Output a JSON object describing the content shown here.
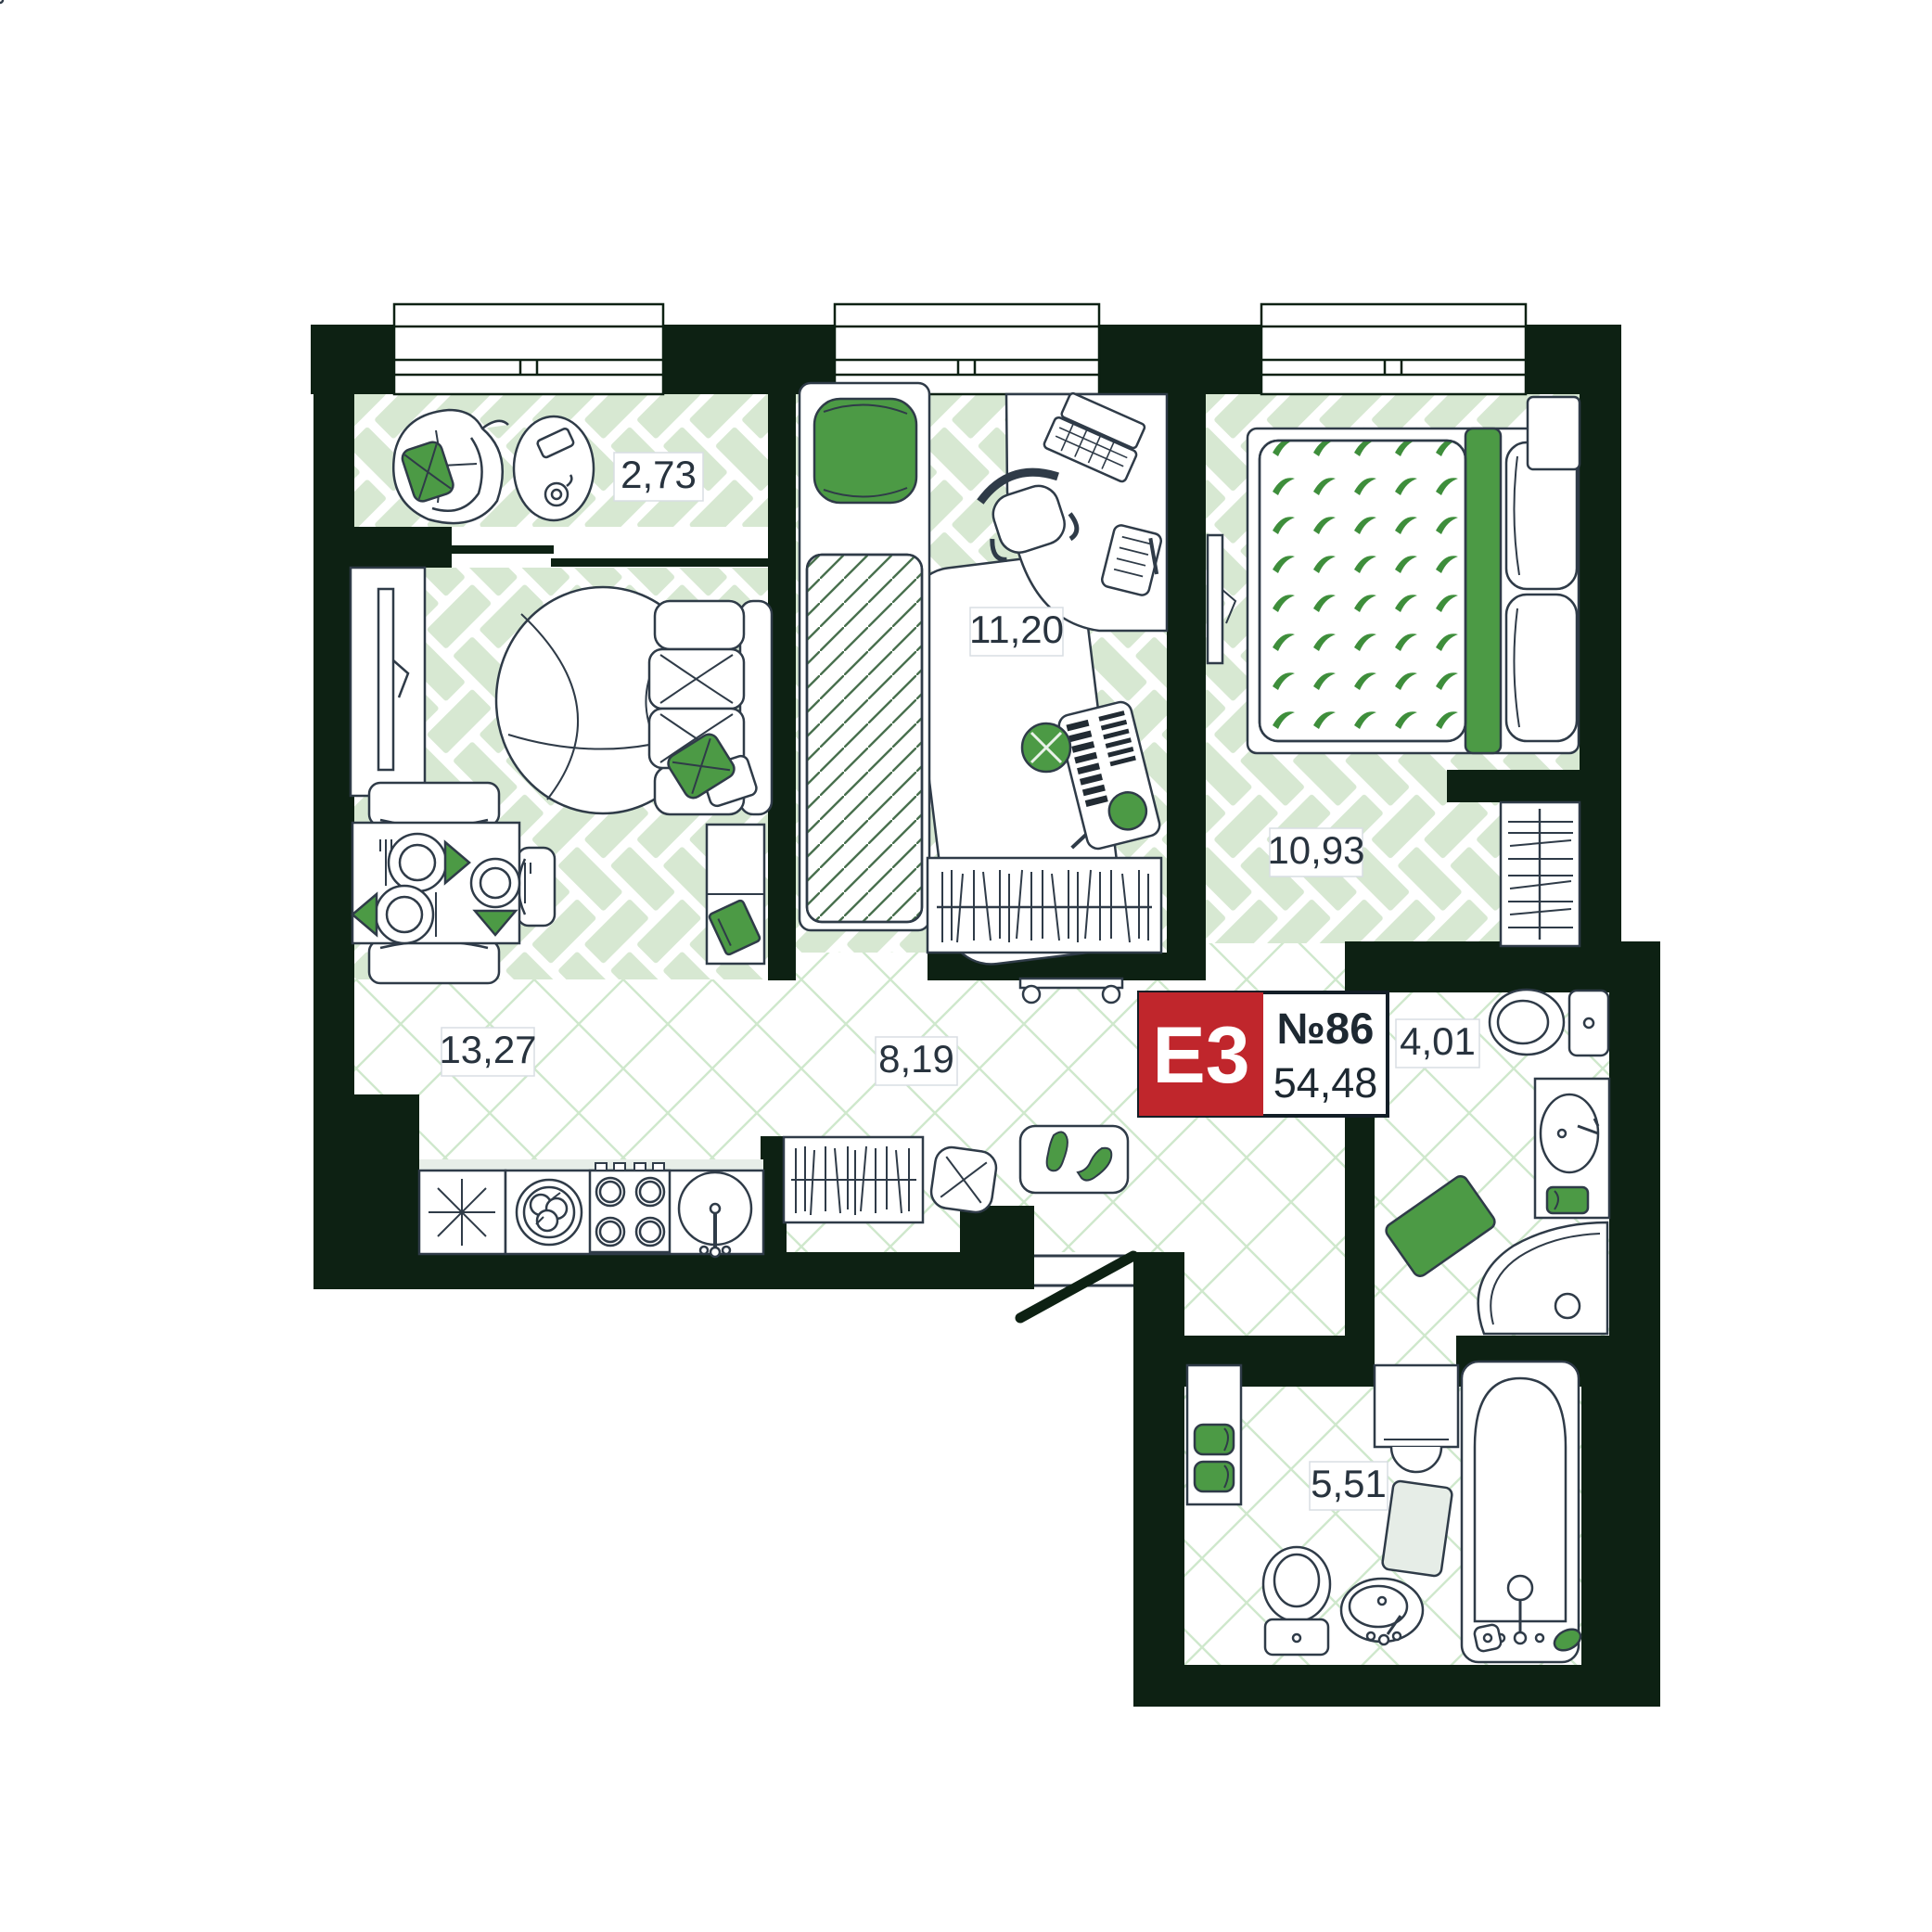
{
  "floorplan": {
    "badge": {
      "unit_type": "E3",
      "unit_number": "№86",
      "total_area": "54,48"
    },
    "rooms": [
      {
        "name": "balcony",
        "area": "2,73"
      },
      {
        "name": "kids-room",
        "area": "11,20"
      },
      {
        "name": "bedroom",
        "area": "10,93"
      },
      {
        "name": "kitchen-living-room",
        "area": "13,27"
      },
      {
        "name": "hallway",
        "area": "8,19"
      },
      {
        "name": "bathroom",
        "area": "4,01"
      },
      {
        "name": "bathroom-2",
        "area": "5,51"
      }
    ],
    "colors": {
      "wall": "#0d2113",
      "accent_green": "#4c9a45",
      "badge_red": "#c0262c",
      "floor_plank_green": "#d7e8d2",
      "lattice_line_green": "#cfe8cc",
      "outline": "#2f3b48"
    }
  }
}
